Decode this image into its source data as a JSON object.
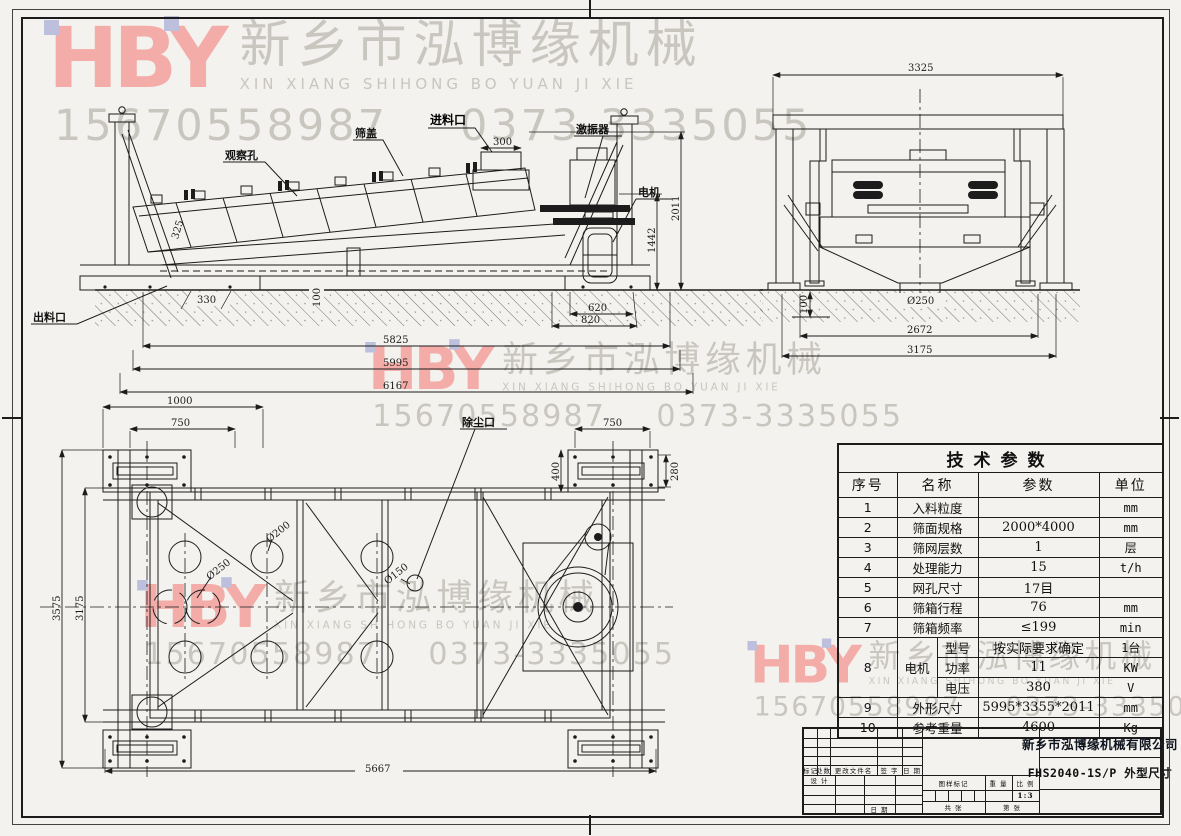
{
  "watermark": {
    "logo": "HBY",
    "company_cn": "新乡市泓博缘机械",
    "company_en": "XIN XIANG SHIHONG BO YUAN JI XIE",
    "phone": "15670558987",
    "tel": "0373-3335055",
    "logo_color": "#f3aca8",
    "text_color": "#c9c6bf"
  },
  "side_view": {
    "labels": {
      "observation_hole": "观察孔",
      "screen_cover": "筛盖",
      "feed_inlet": "进料口",
      "exciter": "激振器",
      "motor": "电机",
      "discharge_outlet": "出料口"
    },
    "dims": {
      "d300": "300",
      "d325": "325",
      "d330": "330",
      "d100": "100",
      "d620": "620",
      "d820": "820",
      "d1442": "1442",
      "d2011": "2011",
      "d5825": "5825",
      "d5995": "5995",
      "d6167": "6167"
    }
  },
  "end_view": {
    "dims": {
      "d3325": "3325",
      "d100": "100",
      "d250": "Ø250",
      "d2672": "2672",
      "d3175": "3175"
    }
  },
  "plan_view": {
    "labels": {
      "dust_port": "除尘口"
    },
    "dims": {
      "d1000": "1000",
      "d750l": "750",
      "d750r": "750",
      "d400": "400",
      "d280": "280",
      "d3575": "3575",
      "d3175": "3175",
      "d5667": "5667",
      "dia250": "Ø250",
      "dia200": "Ø200",
      "dia150": "Ø150"
    }
  },
  "table": {
    "title": "技术参数",
    "headers": [
      "序号",
      "名称",
      "参数",
      "单位"
    ],
    "rows": [
      {
        "no": "1",
        "name": "入料粒度",
        "value": "",
        "unit": "mm"
      },
      {
        "no": "2",
        "name": "筛面规格",
        "value": "2000*4000",
        "unit": "mm"
      },
      {
        "no": "3",
        "name": "筛网层数",
        "value": "1",
        "unit": "层"
      },
      {
        "no": "4",
        "name": "处理能力",
        "value": "15",
        "unit": "t/h"
      },
      {
        "no": "5",
        "name": "网孔尺寸",
        "value": "17目",
        "unit": ""
      },
      {
        "no": "6",
        "name": "筛箱行程",
        "value": "76",
        "unit": "mm"
      },
      {
        "no": "7",
        "name": "筛箱频率",
        "value": "≤199",
        "unit": "min"
      }
    ],
    "motor": {
      "no": "8",
      "name": "电机",
      "rows": [
        {
          "label": "型号",
          "value": "按实际要求确定",
          "unit": "1台"
        },
        {
          "label": "功率",
          "value": "11",
          "unit": "KW"
        },
        {
          "label": "电压",
          "value": "380",
          "unit": "V"
        }
      ]
    },
    "tail": [
      {
        "no": "9",
        "name": "外形尺寸",
        "value": "5995*3355*2011",
        "unit": "mm"
      },
      {
        "no": "10",
        "name": "参考重量",
        "value": "4600",
        "unit": "Kg"
      }
    ]
  },
  "title_block": {
    "company": "新乡市泓博缘机械有限公司",
    "drawing_title": "FHS2040-1S/P  外型尺寸",
    "mark": "标记",
    "count": "处数",
    "change_file": "更改文件名",
    "signature": "签 字",
    "date": "日 期",
    "design": "设 计",
    "date2": "日 期",
    "drawing_mark": "图样标记",
    "weight": "重 量",
    "scale": "比 例",
    "scale_value": "1:3",
    "sheet_total": "共  张",
    "sheet_no": "第  张"
  }
}
